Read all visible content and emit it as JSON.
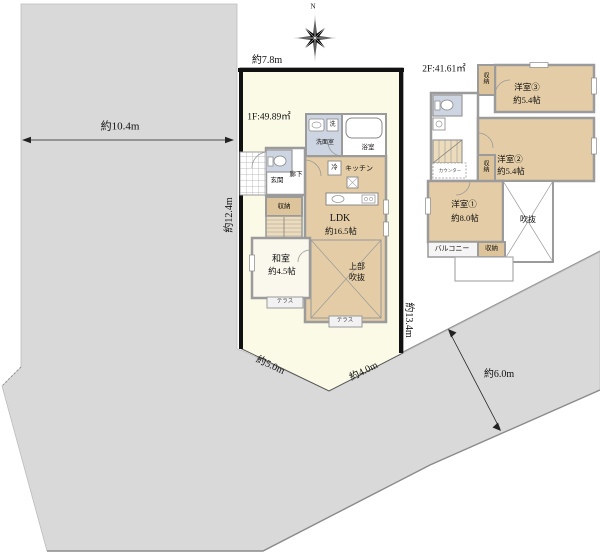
{
  "compass": {
    "north": "N"
  },
  "dimensions": {
    "outer_width": "約10.4m",
    "top_edge": "約7.8m",
    "left_edge": "約12.4m",
    "right_edge": "約13.4m",
    "bottom_left_edge": "約5.0m",
    "bottom_right_edge": "約4.0m",
    "road_width": "約6.0m"
  },
  "floor1": {
    "area": "1F:49.89㎡",
    "bath": "浴室",
    "washroom": "洗面室",
    "washer": "洗",
    "fridge": "冷",
    "kitchen": "キッチン",
    "hallway": "廊下",
    "entrance": "玄関",
    "closet": "収納",
    "ldk": "LDK",
    "ldk_size": "約16.5帖",
    "japanese_room": "和室",
    "japanese_room_size": "約4.5帖",
    "void_upper_line1": "上部",
    "void_upper_line2": "吹抜",
    "terrace_west": "テラス",
    "terrace_south": "テラス"
  },
  "floor2": {
    "area": "2F:41.61㎡",
    "room3": "洋室③",
    "room3_size": "約5.4帖",
    "room2": "洋室②",
    "room2_size": "約5.4帖",
    "room1": "洋室①",
    "room1_size": "約8.0帖",
    "void": "吹抜",
    "balcony": "バルコニー",
    "closet_top": "収納",
    "closet_mid": "収納",
    "closet_bottom": "収納",
    "counter": "カウンター"
  },
  "colors": {
    "land_gray": "#d9d9d9",
    "parcel_cream": "#fafae6",
    "room_tan": "#e4cda6",
    "closet_tan": "#dec49a",
    "wet_area_lavender": "#cdd4e2",
    "wall_gray": "#9b9b9b",
    "plot_border_black": "#111111"
  }
}
